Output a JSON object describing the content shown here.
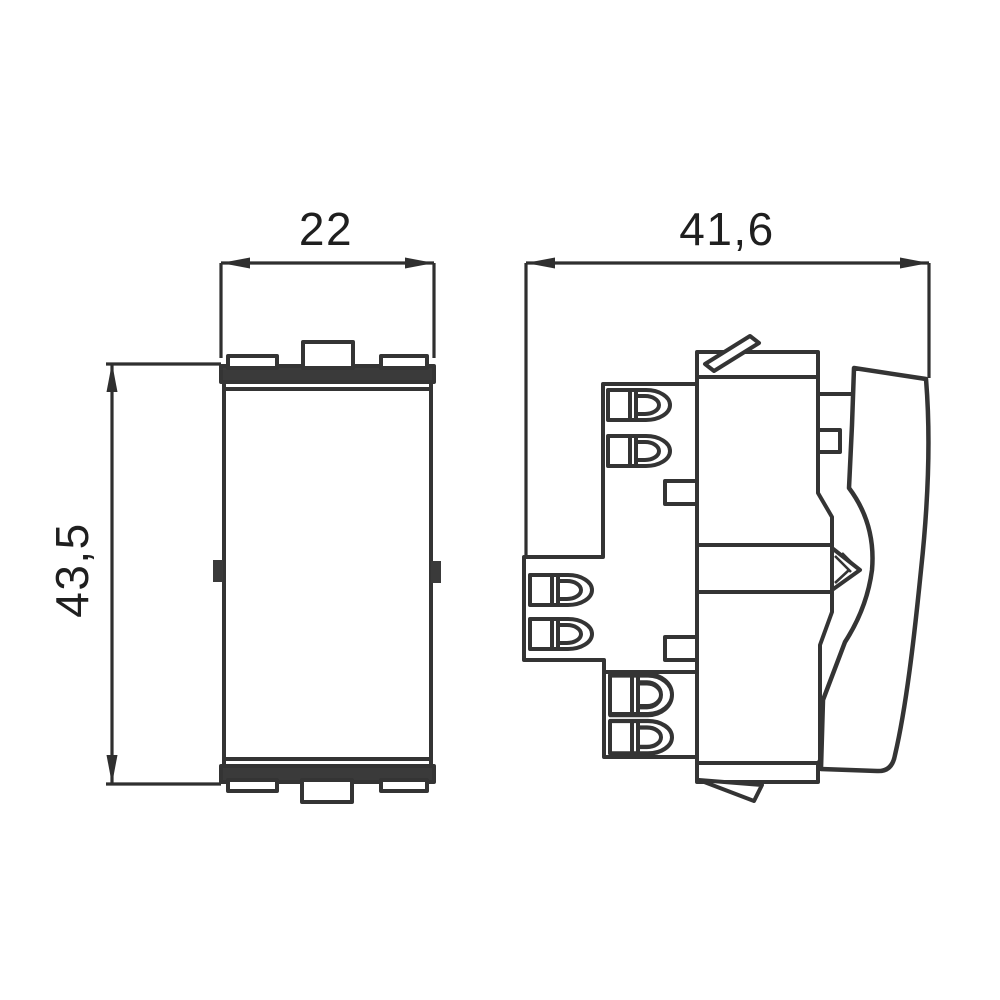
{
  "drawing": {
    "background_color": "#ffffff",
    "line_color": "#343434",
    "dimension_line_color": "#2f2f2f",
    "dark_fill_color": "#3a3a3a",
    "label_color": "#1f1f1f",
    "dimensions": {
      "front_width": "22",
      "front_height": "43,5",
      "side_depth": "41,6"
    }
  }
}
